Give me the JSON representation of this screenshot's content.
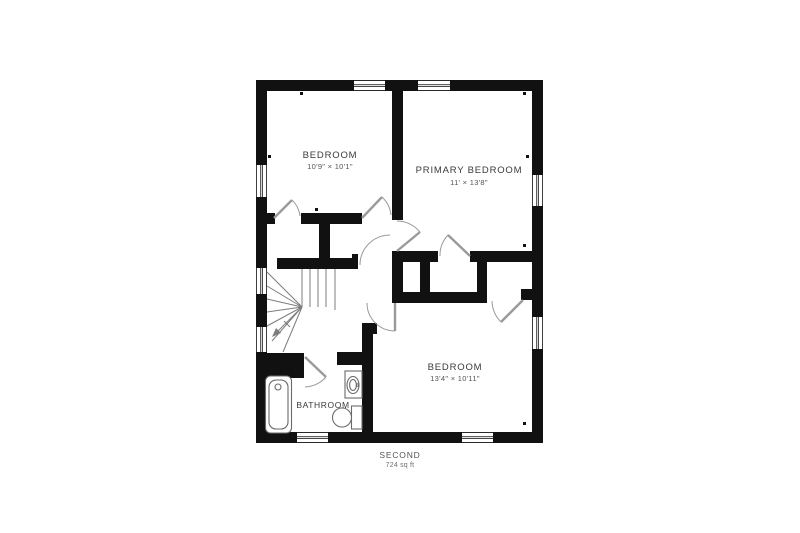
{
  "title": {
    "floor_label": "SECOND",
    "floor_area": "724 sq ft"
  },
  "rooms": [
    {
      "name": "BEDROOM",
      "dimensions": "10'9\" × 10'1\""
    },
    {
      "name": "PRIMARY BEDROOM",
      "dimensions": "11' × 13'8\""
    },
    {
      "name": "BEDROOM",
      "dimensions": "13'4\" × 10'11\""
    },
    {
      "name": "BATHROOM",
      "dimensions": ""
    }
  ],
  "fixtures": [
    "bathtub",
    "sink",
    "toilet",
    "staircase"
  ],
  "colors": {
    "bg": "#ffffff",
    "wall": "#111111",
    "text": "#3a3a3a",
    "dim": "#545454",
    "dim2": "#6f6f6f",
    "arc": "#9a9a9a",
    "fixture": "#6a6a6a",
    "stair": "#7d7d7d",
    "winline": "#2a2a2a"
  }
}
